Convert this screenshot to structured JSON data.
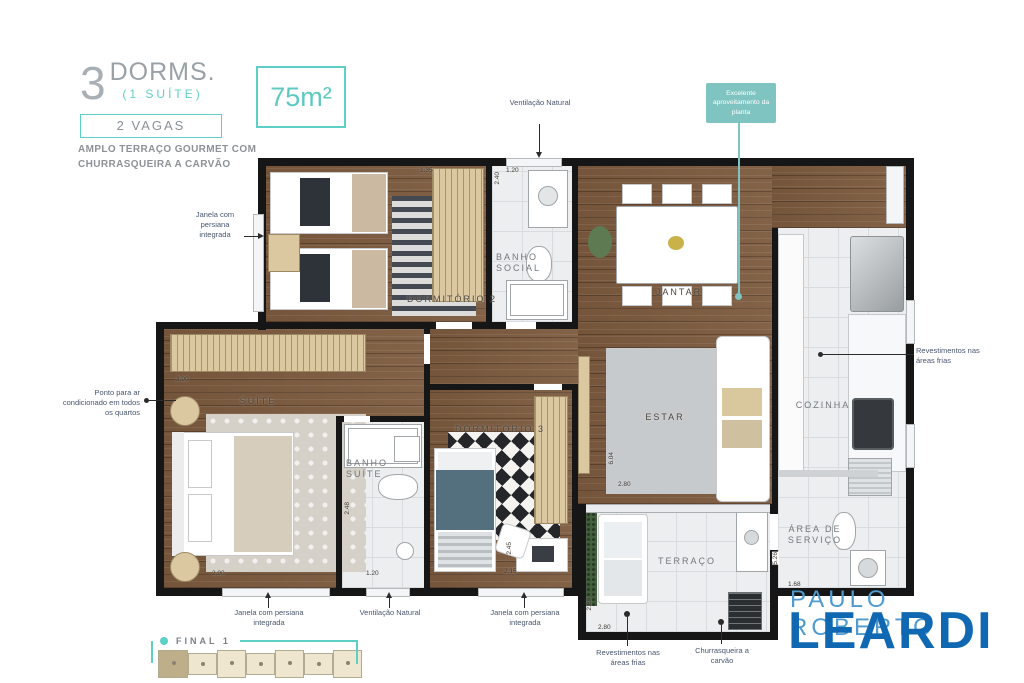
{
  "header": {
    "big_number": "3",
    "title": "DORMS.",
    "subtitle": "(1 SUÍTE)",
    "parking_badge": "2 VAGAS",
    "tagline_1": "AMPLO TERRAÇO GOURMET COM",
    "tagline_2": "CHURRASQUEIRA A CARVÃO",
    "area_badge": "75m²"
  },
  "callout": {
    "text": "Excelente aproveitamento da planta"
  },
  "rooms": {
    "dormitorio2": "DORMITÓRIO 2",
    "banho_social": "BANHO SOCIAL",
    "jantar": "JANTAR",
    "suite": "SUÍTE",
    "banho_suite": "BANHO SUÍTE",
    "dormitorio3": "DORMITÓRIO 3",
    "estar": "ESTAR",
    "cozinha": "COZINHA",
    "area_servico": "ÁREA DE SERVIÇO",
    "terraco": "TERRAÇO"
  },
  "annotations": {
    "janela_dorm2": "Janela com persiana integrada",
    "ventilacao_banho_social": "Ventilação Natural",
    "ar_condicionado": "Ponto para ar condicionado em todos os quartos",
    "revestimentos_cozinha": "Revestimentos nas áreas frias",
    "janela_suite": "Janela com persiana integrada",
    "ventilacao_banho_suite": "Ventilação Natural",
    "janela_dorm3": "Janela com persiana integrada",
    "revestimentos_terraco": "Revestimentos nas áreas frias",
    "churrasqueira": "Churrasqueira a carvão"
  },
  "dimensions": {
    "dorm2_w": "1.35",
    "banho_social_w": "1.20",
    "banho_social_h": "2.40",
    "suite_w": "3.90",
    "suite_window": "2.90",
    "banho_suite_h": "2.48",
    "banho_suite_w": "1.20",
    "dorm3_h": "2.45",
    "dorm3_w": "2.15",
    "estar_h": "6.04",
    "estar_w": "2.80",
    "terraco_h": "2.80",
    "terraco_w": "2.80",
    "servico_h": "5.26",
    "servico_w": "1.68"
  },
  "footer": {
    "unit_label": "FINAL 1"
  },
  "logo": {
    "top_line": "PAULO ROBERTO",
    "name": "LEARDI"
  },
  "colors": {
    "accent": "#5ecfc7",
    "callout_bg": "#7fc4c1",
    "logo_light": "#4f9bcd",
    "logo_dark": "#1168b2"
  }
}
